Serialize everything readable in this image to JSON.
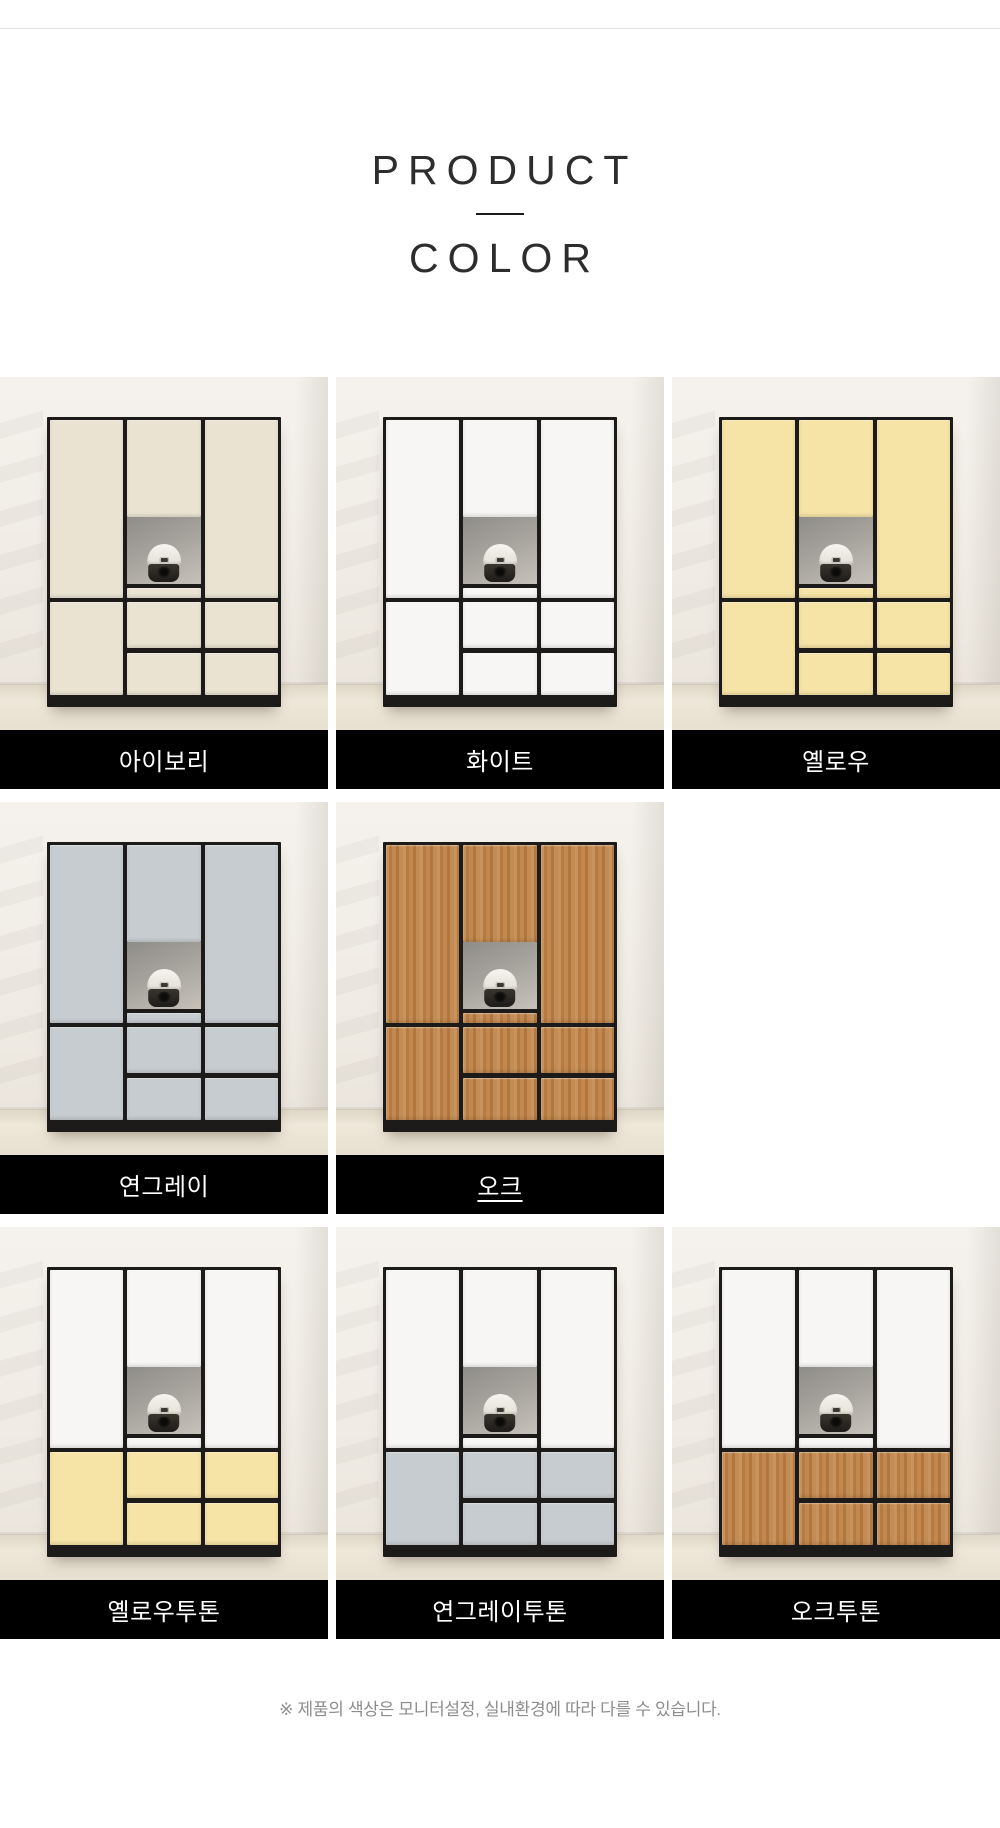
{
  "section": {
    "title_line1": "PRODUCT",
    "title_line2": "COLOR",
    "disclaimer": "※ 제품의 색상은 모니터설정, 실내환경에 따라 다를 수 있습니다."
  },
  "palette": {
    "ivory": "#eae3d2",
    "white": "#f7f6f4",
    "yellow": "#f6e3a6",
    "gray": "#c7ccd0",
    "oak": "#bf8348",
    "frame_black": "#1d1b19",
    "label_bar_bg": "#000000",
    "label_text": "#ffffff",
    "wall": "#f0ece5",
    "floor": "#e9e2d3",
    "disclaimer_text": "#8d8d8d"
  },
  "swatches": [
    {
      "id": "ivory",
      "label": "아이보리",
      "top": "ivory",
      "bottom": "ivory",
      "underline": false
    },
    {
      "id": "white",
      "label": "화이트",
      "top": "white",
      "bottom": "white",
      "underline": false
    },
    {
      "id": "yellow",
      "label": "옐로우",
      "top": "yellow",
      "bottom": "yellow",
      "underline": false
    },
    {
      "id": "light-gray",
      "label": "연그레이",
      "top": "gray",
      "bottom": "gray",
      "underline": false
    },
    {
      "id": "oak",
      "label": "오크",
      "top": "oak",
      "bottom": "oak",
      "underline": true
    },
    {
      "id": "yellow-twotone",
      "label": "옐로우투톤",
      "top": "white",
      "bottom": "yellow",
      "underline": false
    },
    {
      "id": "light-gray-twotone",
      "label": "연그레이투톤",
      "top": "white",
      "bottom": "gray",
      "underline": false
    },
    {
      "id": "oak-twotone",
      "label": "오크투톤",
      "top": "white",
      "bottom": "oak",
      "underline": false
    }
  ]
}
